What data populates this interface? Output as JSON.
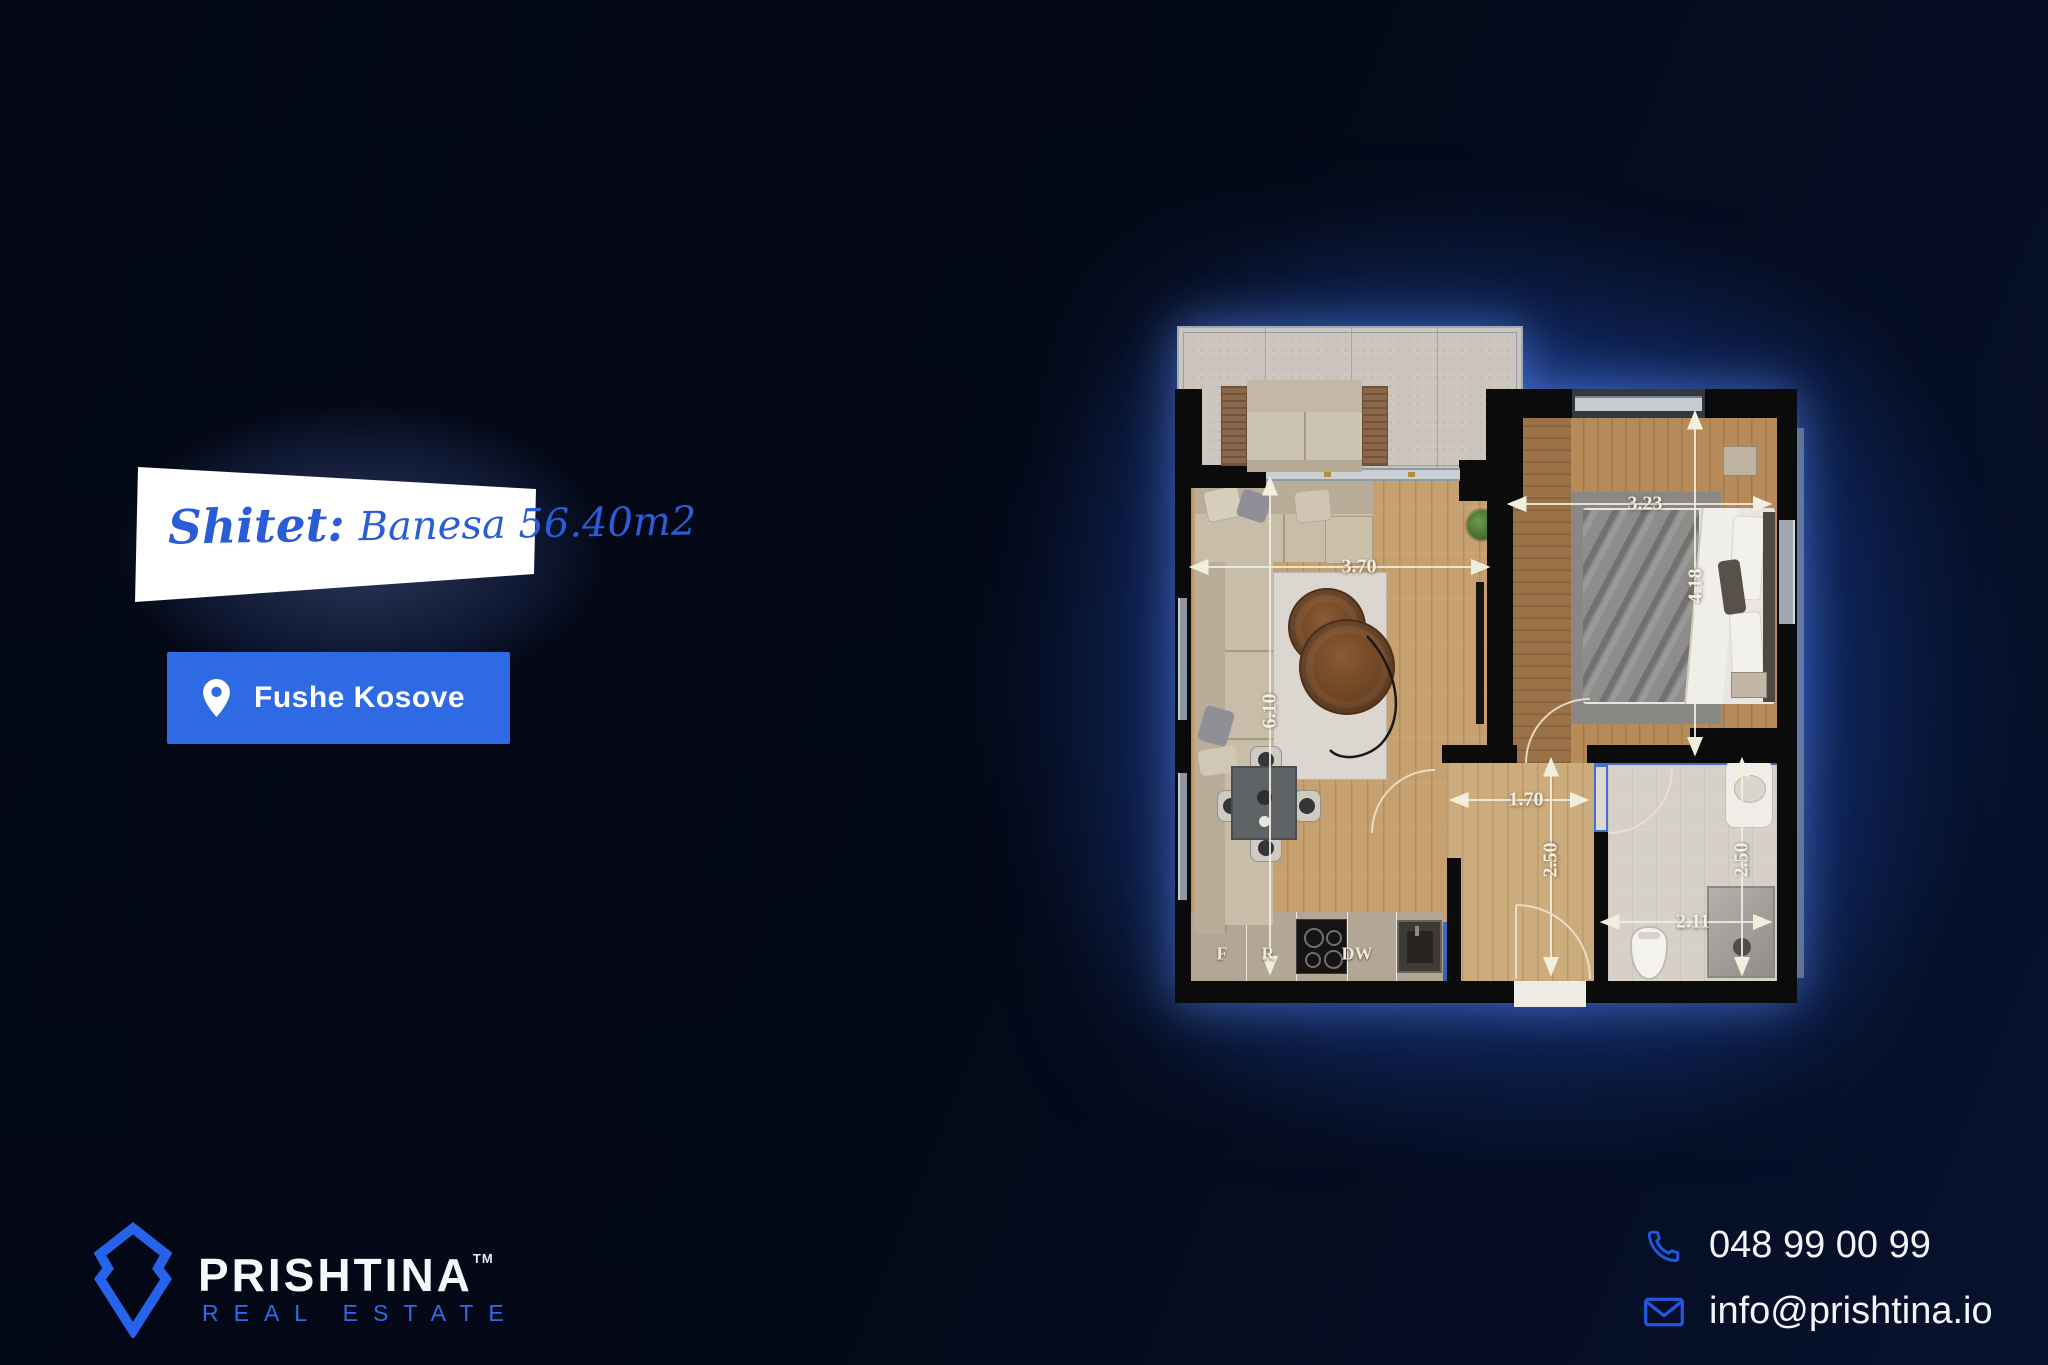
{
  "banner": {
    "sale_label": "Shitet:",
    "property": "Banesa 56.40m2"
  },
  "location": {
    "label": "Fushe Kosove"
  },
  "plan": {
    "dims": {
      "living_width": "3.70",
      "living_height": "6.10",
      "bedroom_width": "3.23",
      "bedroom_height": "4.18",
      "hall_width": "1.70",
      "hall_height": "2.50",
      "bath_width": "2.11",
      "bath_height": "2.50"
    },
    "kitchen": {
      "fridge": "F",
      "range": "R",
      "dishwasher": "DW"
    }
  },
  "brand": {
    "name": "PRISHTINA",
    "trademark": "TM",
    "tagline": "REAL ESTATE"
  },
  "contact": {
    "phone": "048 99 00 99",
    "email": "info@prishtina.io"
  },
  "colors": {
    "background": "#040918",
    "accent_blue": "#2e6ae4",
    "banner_text_blue": "#2b5cd8",
    "logo_blue": "#2563eb",
    "glow_blue": "#2f6fe0"
  }
}
